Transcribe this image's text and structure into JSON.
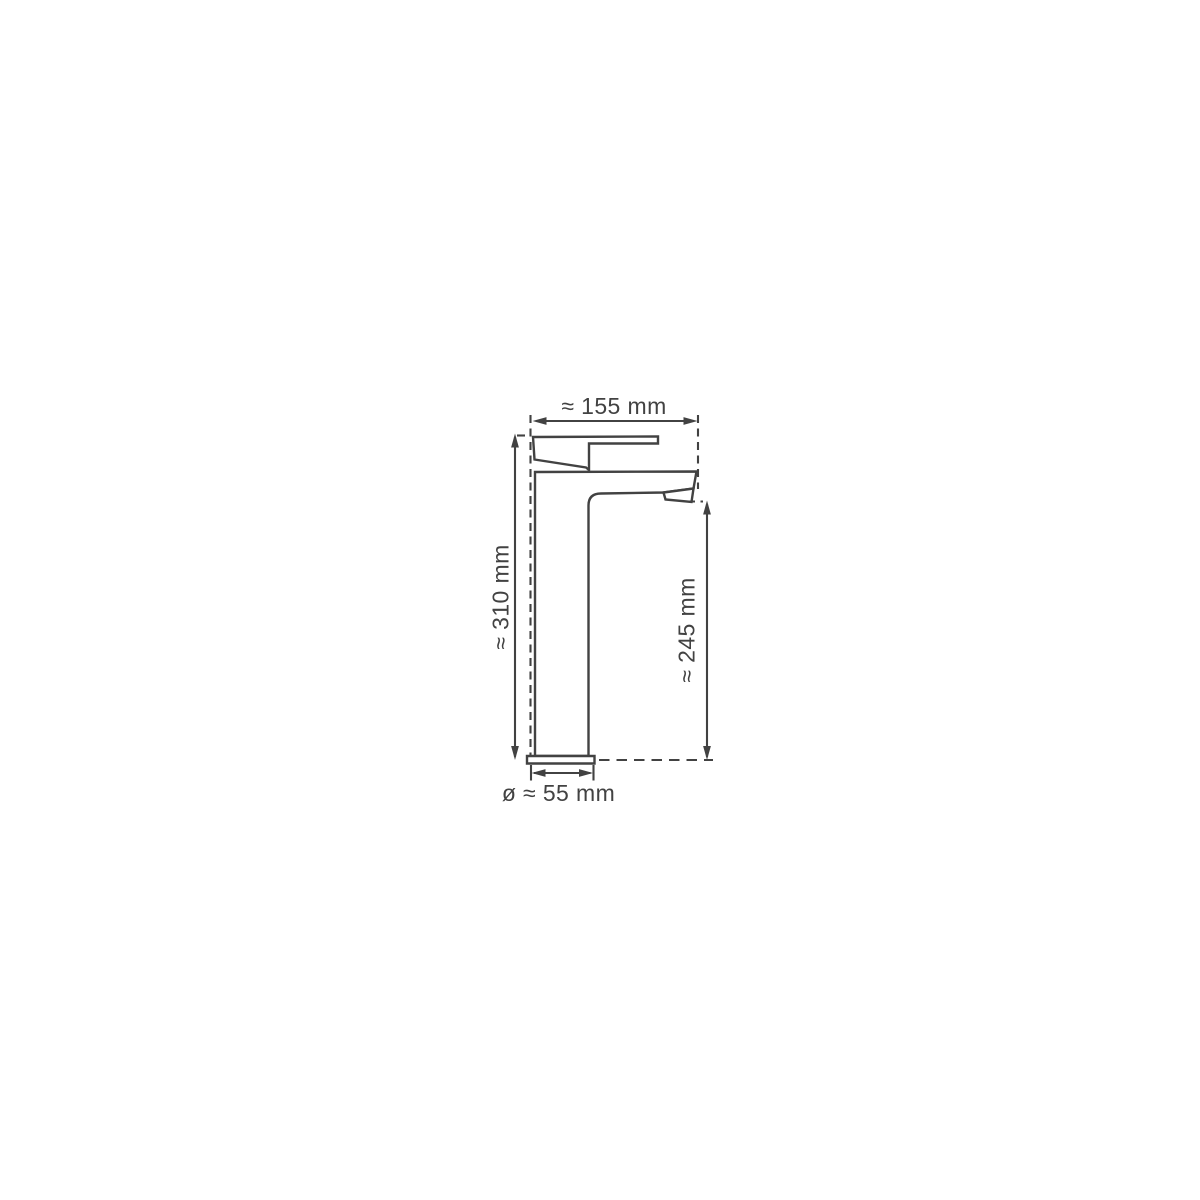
{
  "diagram": {
    "subject": "single-lever-tall-basin-mixer-faucet-side-view",
    "dimensions": {
      "top_width": "≈ 155 mm",
      "left_height": "≈ 310 mm",
      "right_height": "≈ 245 mm",
      "base_diameter": "ø ≈ 55 mm"
    },
    "style": {
      "line_color": "#424242",
      "background_color": "#ffffff"
    }
  }
}
